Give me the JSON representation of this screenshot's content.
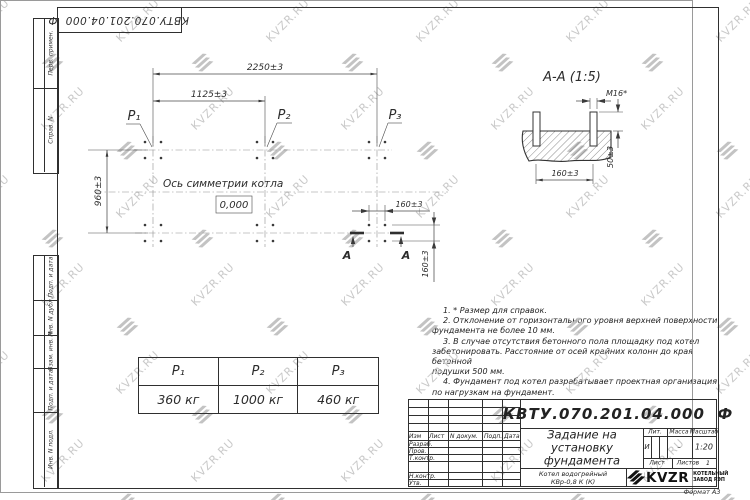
{
  "colors": {
    "line": "#3a3a3a",
    "watermark_text": "#c9c9c9",
    "watermark_glyph": "#b9b9b9"
  },
  "page": {
    "watermark_text": "KVZR.RU",
    "format_label": "Формат А3"
  },
  "corner_stamp": {
    "doc_number": "КВТУ.070.201.04.000  Ф"
  },
  "margin_labels": {
    "perv_primen": "Перв. примен.",
    "sprav_n": "Справ. N",
    "podp_data_1": "Подп. и дата",
    "inv_dubl": "Инв. N дубл.",
    "vzam_inv": "Взам. инв. N",
    "podp_data_2": "Подп. и дата",
    "inv_podl": "Инв. N подл."
  },
  "plan": {
    "dim_2250": "2250±3",
    "dim_1125": "1125±3",
    "dim_960": "960±3",
    "dim_160_h": "160±3",
    "dim_160_v": "160±3",
    "p1": "Р₁",
    "p2": "Р₂",
    "p3": "Р₃",
    "axis_label": "Ось симметрии котла",
    "elevation": "0,000",
    "section_letter_left": "А",
    "section_letter_right": "А"
  },
  "section": {
    "title": "А-А (1:5)",
    "dim_m16": "М16*",
    "dim_50": "50±3",
    "dim_160": "160±3"
  },
  "notes": {
    "lines": [
      "1. * Размер для справок.",
      "2. Отклонение от горизонтального уровня верхней поверхности",
      "фундамента не более 10 мм.",
      "3. В случае отсутствия бетонного пола площадку под котел",
      "забетонировать. Расстояние от осей крайних колонн до края бетонной",
      "подушки 500 мм.",
      "4. Фундамент под котел разрабатывает проектная организация",
      "по нагрузкам на фундамент."
    ]
  },
  "load_table": {
    "headers": [
      "Р₁",
      "Р₂",
      "Р₃"
    ],
    "values": [
      "360 кг",
      "1000 кг",
      "460 кг"
    ]
  },
  "title_block": {
    "doc_number": "КВТУ.070.201.04.000  Ф",
    "title_lines": [
      "Задание на",
      "установку",
      "фундамента"
    ],
    "product_lines": [
      "Котел водогрейный",
      "КВр-0,8 К (К)"
    ],
    "header_izm": "Изм",
    "header_list": "Лист",
    "header_ndok": "N докум.",
    "header_podp": "Подп.",
    "header_data": "Дата",
    "row_razrab": "Разраб.",
    "row_prov": "Пров.",
    "row_tkontr": "Т.контр.",
    "row_nkontr": "Н.контр.",
    "row_utv": "Утв.",
    "lit_header": "Лит.",
    "mass_header": "Масса",
    "scale_header": "Масштаб",
    "lit_value": "И",
    "mass_value": "–",
    "scale_value": "1:20",
    "sheet_label": "Лист",
    "sheets_label": "Листов",
    "sheets_value": "1",
    "company_name": "KVZR",
    "company_line1": "КОТЕЛЬНЫЙ",
    "company_line2": "ЗАВОД РЭП"
  }
}
